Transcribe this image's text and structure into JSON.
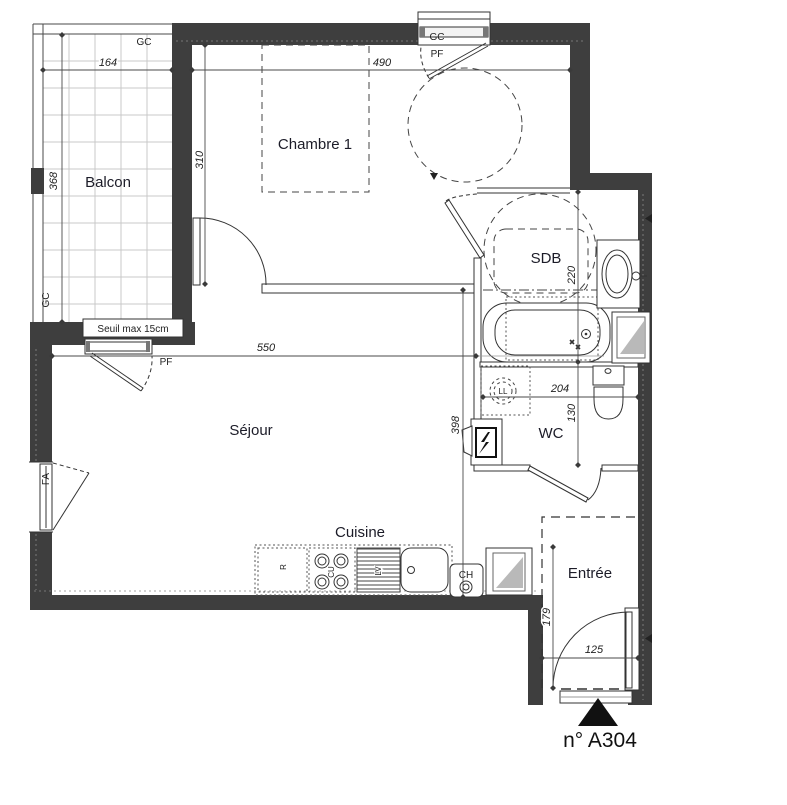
{
  "title": "n° A304",
  "rooms": {
    "balcon": "Balcon",
    "chambre": "Chambre 1",
    "sdb": "SDB",
    "sejour": "Séjour",
    "wc": "WC",
    "cuisine": "Cuisine",
    "entree": "Entrée"
  },
  "windows": {
    "gc_top": "GC",
    "pf_top": "PF",
    "gc_side": "GC",
    "pf_side": "PF",
    "fa": "FA",
    "sill_note": "Seuil max 15cm"
  },
  "fixtures": {
    "washing_machine": "LL",
    "fridge": "R",
    "hob": "CU",
    "dishwasher": "LV",
    "boiler": "CH"
  },
  "dims": {
    "balcon_width": "164",
    "balcon_depth": "368",
    "chambre_width": "490",
    "chambre_depth": "310",
    "sejour_width": "550",
    "sejour_depth": "398",
    "sdb_depth": "220",
    "wc_width": "204",
    "wc_depth": "130",
    "entree_depth": "179",
    "entree_width": "125"
  },
  "colors": {
    "wall": "#3e3e3e",
    "grid": "#cccccc",
    "glass_shade": "#b9b9b9"
  }
}
